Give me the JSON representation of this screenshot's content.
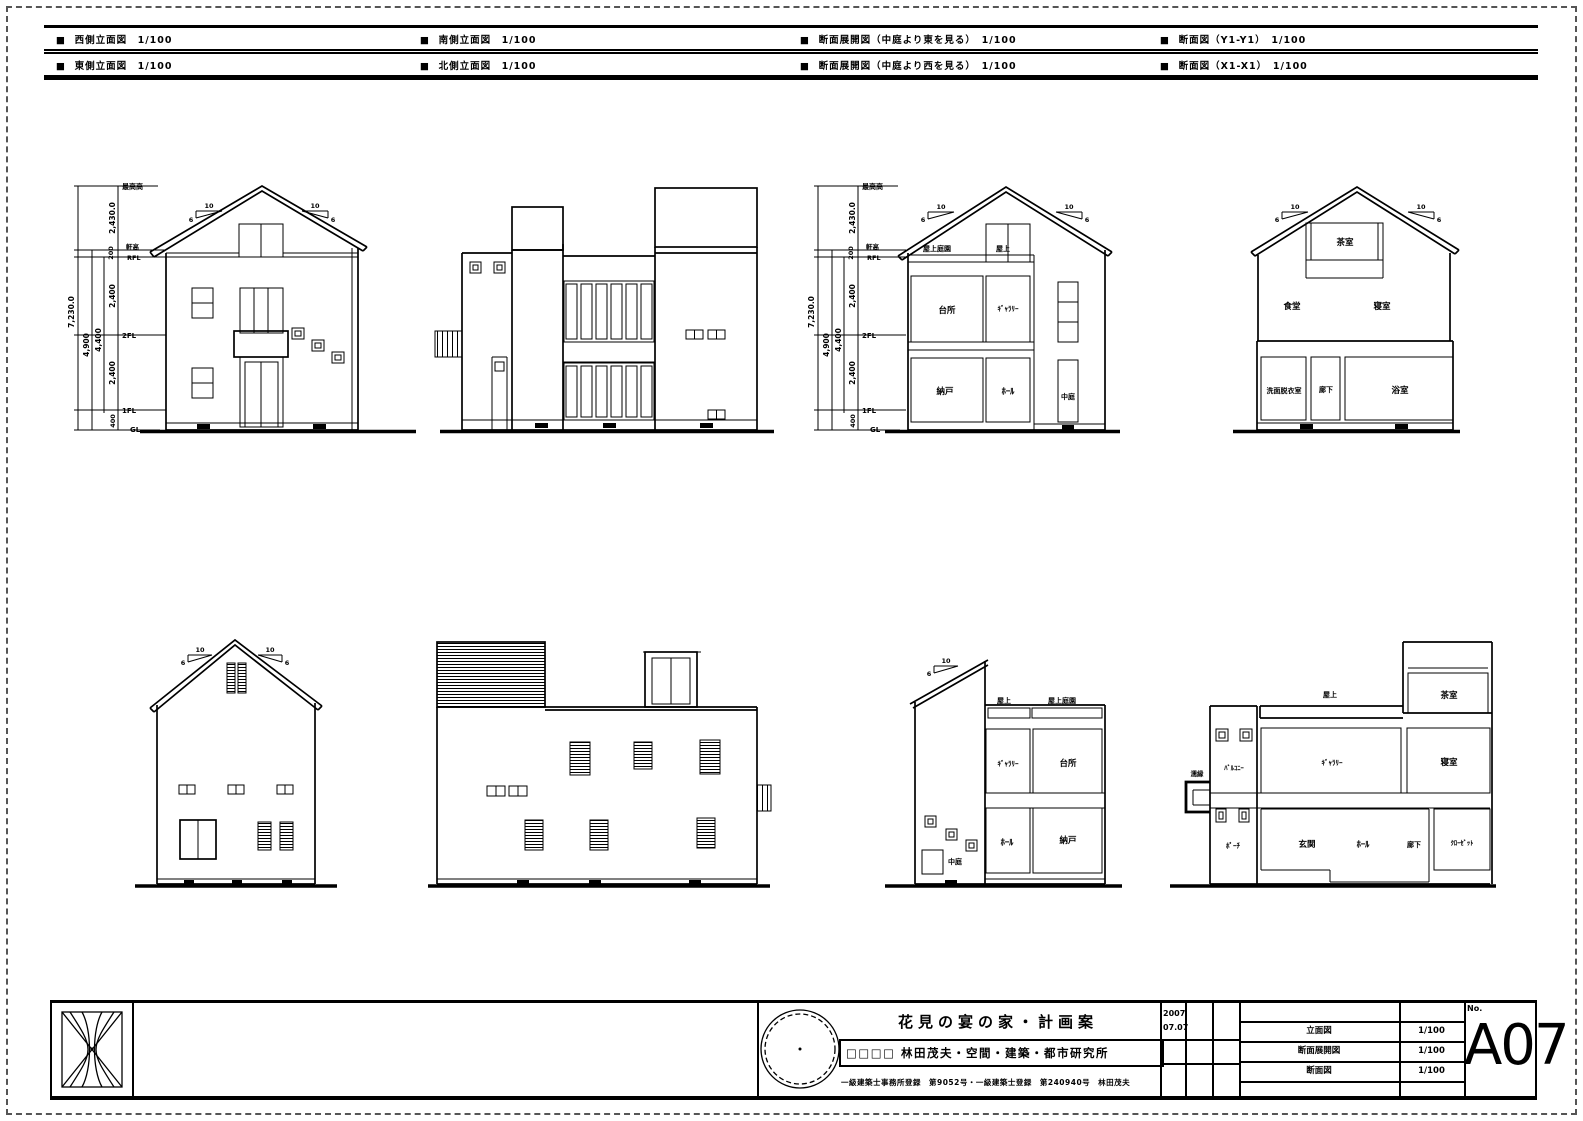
{
  "header": {
    "row1": [
      "■  西側立面図　1/100",
      "■  南側立面図　1/100",
      "■  断面展開図（中庭より東を見る）　1/100",
      "■  断面図（Y1-Y1）　1/100"
    ],
    "row2": [
      "■  東側立面図　1/100",
      "■  北側立面図　1/100",
      "■  断面展開図（中庭より西を見る）　1/100",
      "■  断面図（X1-X1）　1/100"
    ]
  },
  "dims": {
    "levels": {
      "max_height": "最高高",
      "eave_height": "軒高",
      "rfl": "RFL",
      "f2": "2FL",
      "f1": "1FL",
      "gl": "GL"
    },
    "segments": {
      "top": "2,430.0",
      "eave": "200",
      "upper": "2,400",
      "lower": "2,400",
      "base": "400"
    },
    "totals": {
      "overall": "7,230.0",
      "to_eave": "4,900",
      "inner": "4,400"
    },
    "pitch": {
      "run": "10",
      "rise": "6"
    }
  },
  "rooms": {
    "roof_garden": "屋上庭園",
    "roof": "屋上",
    "kitchen": "台所",
    "gallery": "ｷﾞｬﾗﾘｰ",
    "storage": "納戸",
    "hall": "ﾎｰﾙ",
    "courtyard": "中庭",
    "tea_room": "茶室",
    "dining": "食堂",
    "bedroom": "寝室",
    "washroom": "洗面脱衣室",
    "corridor": "廊下",
    "bath": "浴室",
    "balcony": "ﾊﾞﾙｺﾆｰ",
    "veranda": "濡縁",
    "porch": "ﾎﾟｰﾁ",
    "entrance": "玄関",
    "closet": "ｸﾛｰｾﾞｯﾄ"
  },
  "titleblock": {
    "project_title": "花見の宴の家・計画案",
    "firm": "□□□□ 林田茂夫・空間・建築・都市研究所",
    "license": "一級建築士事務所登録　第9052号・一級建築士登録　第240940号　林田茂夫",
    "date_year": "2007",
    "date_md": "07.07",
    "drawing_list": [
      {
        "name": "立面図",
        "scale": "1/100"
      },
      {
        "name": "断面展開図",
        "scale": "1/100"
      },
      {
        "name": "断面図",
        "scale": "1/100"
      }
    ],
    "sheet_no_label": "No.",
    "sheet_no": "A07"
  }
}
